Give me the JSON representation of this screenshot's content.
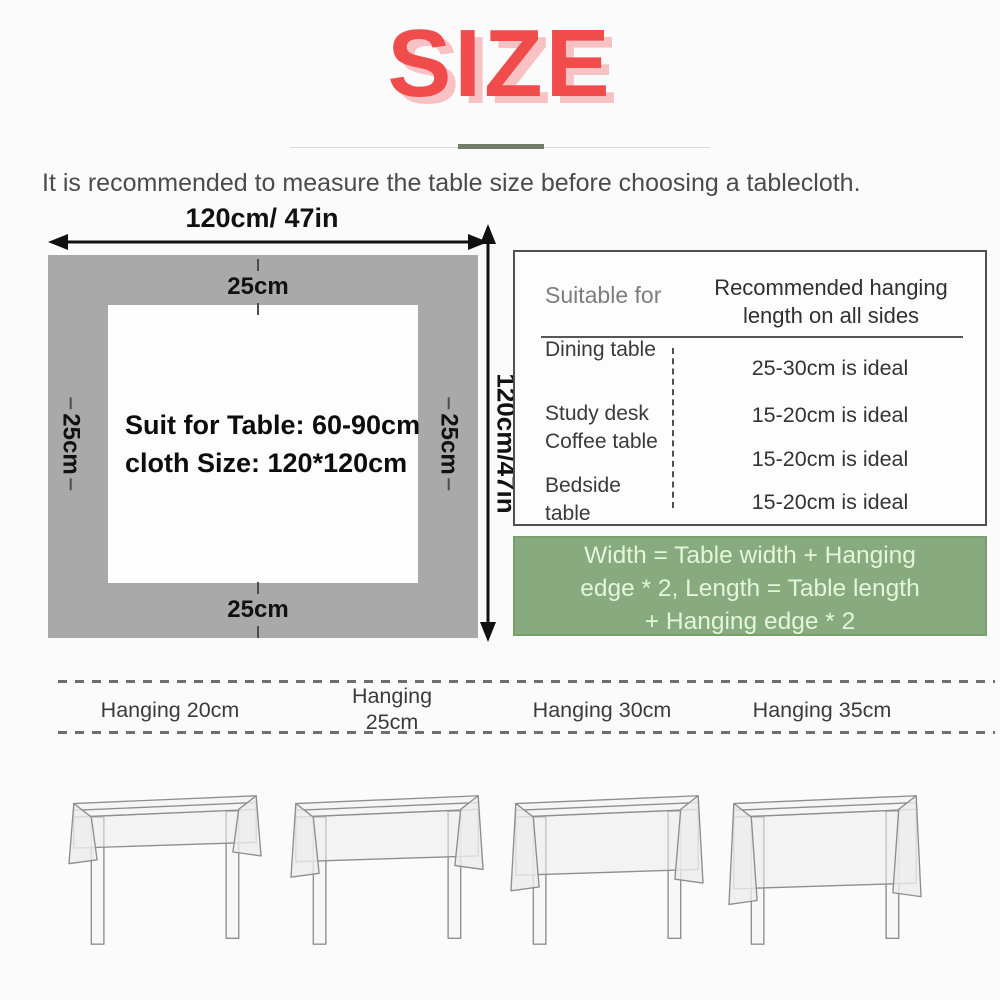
{
  "title": {
    "text": "SIZE"
  },
  "intro": "It is recommended to measure the table size before choosing a tablecloth.",
  "diagram": {
    "width_label": "120cm/ 47in",
    "height_label": "120cm/47in",
    "hang_top": "25cm",
    "hang_bottom": "25cm",
    "hang_left": "25cm",
    "hang_right": "25cm",
    "center_line1": "Suit for Table: 60-90cm",
    "center_line2": "cloth Size: 120*120cm"
  },
  "info_table": {
    "col1_header": "Suitable for",
    "col2_header": "Recommended hanging\nlength on all sides",
    "rows": [
      {
        "item": "Dining table",
        "length": "25-30cm is ideal"
      },
      {
        "item": "Study desk",
        "length": "15-20cm is ideal"
      },
      {
        "item": "Coffee table",
        "length": "15-20cm is ideal"
      },
      {
        "item": "Bedside table",
        "length": "15-20cm is ideal"
      }
    ]
  },
  "formula": "Width = Table width + Hanging\nedge * 2, Length = Table length\n+ Hanging edge * 2",
  "hanging": {
    "labels": [
      "Hanging 20cm",
      "Hanging\n25cm",
      "Hanging 30cm",
      "Hanging 35cm"
    ]
  },
  "colors": {
    "accent_red": "#f14c4c",
    "accent_red_shadow": "#f8c2c4",
    "cloth_gray": "#a9a9a9",
    "formula_green_bg": "#87aa7e",
    "formula_green_text": "#e3f5da"
  }
}
